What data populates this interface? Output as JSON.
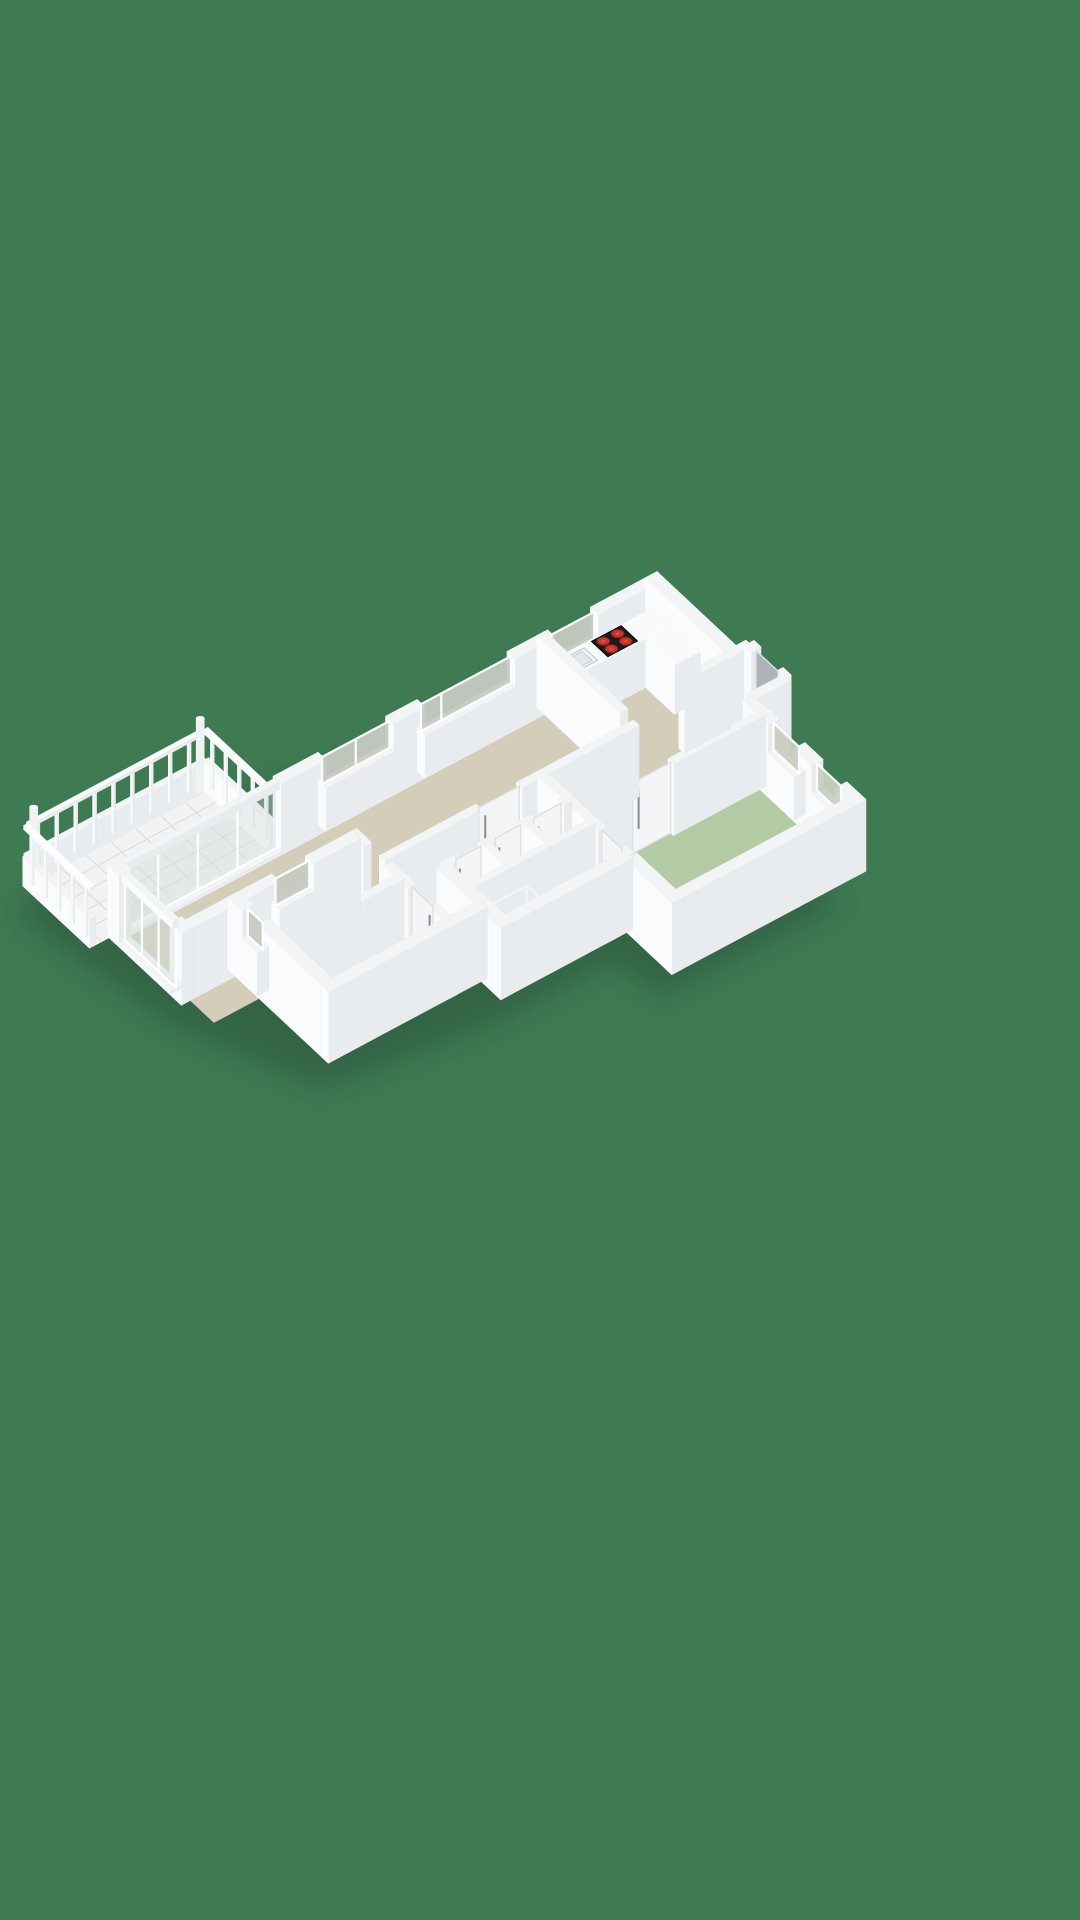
{
  "canvas": {
    "width": 1080,
    "height": 1920,
    "background": "#3E7A52"
  },
  "palette": {
    "bg": "#3E7A52",
    "shadow": "#26523A",
    "wallTop": "#F2F4F5",
    "faceSW": "#FAFBFC",
    "faceSE": "#E9ECEE",
    "faceNE": "#C6CACE",
    "faceNW": "#DADDE0",
    "floorBeige": "#D4CDBA",
    "floorGreen": "#B3CBA4",
    "floorBlue": "#8FA7C3",
    "floorLight": "#E8E6DF",
    "tile": "#F0F2F3",
    "grout": "#D9DCDE",
    "glassWin": "#C5C9C1",
    "glassGreen": "#C9CFC0",
    "glassSlide": "#D4DCDB",
    "glassShower": "#E6EDF1",
    "counterTop": "#F8FAFB",
    "doorWhite": "#F4F5F6",
    "doorGray": "#ADB3B8",
    "handle": "#878D92",
    "cooktop": "#1A1B1D",
    "burner": "#C8342B",
    "equipRed": "#B23028",
    "equipDark": "#2A2D30",
    "post": "#EFF2F3",
    "trayWhite": "#EDF0F2",
    "sinkFill": "#F2F5F6",
    "sinkEdge": "#C9CED2"
  },
  "projection": {
    "ox": 655,
    "oy": 650,
    "xx": 30,
    "xy": 28,
    "yx": -45,
    "yy": 24,
    "zz": 56,
    "wall_height": 1.28
  },
  "scene": [
    {
      "t": "shadow",
      "name": "ground-shadow",
      "pts": [
        [
          0.4,
          0.5
        ],
        [
          7.8,
          1.0
        ],
        [
          7.7,
          4.9
        ],
        [
          6.3,
          5.1
        ],
        [
          6.3,
          7.6
        ],
        [
          5.7,
          11.1
        ],
        [
          2.4,
          12.3
        ],
        [
          -2.1,
          12.8
        ],
        [
          -2.4,
          8.7
        ],
        [
          0.2,
          2.5
        ]
      ],
      "blur": 14,
      "op": 0.55
    },
    {
      "t": "floor",
      "name": "floor-kitchen",
      "r": [
        0.1,
        0.1,
        2.62,
        2.45
      ],
      "c": "floorBeige"
    },
    {
      "t": "floor",
      "name": "floor-hall",
      "r": [
        2.45,
        -0.22,
        4.42,
        4.62
      ],
      "c": "floorBeige"
    },
    {
      "t": "floor",
      "name": "floor-living-room",
      "r": [
        0.1,
        2.45,
        3.12,
        11.88
      ],
      "c": "floorBeige"
    },
    {
      "t": "floor",
      "name": "floor-corridor",
      "r": [
        3.05,
        4.55,
        3.95,
        8.15
      ],
      "c": "floorBeige"
    },
    {
      "t": "floor",
      "name": "floor-green-bedroom",
      "r": [
        4.35,
        0.6,
        7.4,
        4.5
      ],
      "c": "floorGreen"
    },
    {
      "t": "floor",
      "name": "floor-tech-closet",
      "r": [
        3.95,
        4.6,
        4.75,
        5.5
      ],
      "c": "floorLight"
    },
    {
      "t": "floor",
      "name": "floor-closets",
      "r": [
        3.95,
        5.5,
        4.75,
        7.3
      ],
      "c": "floorLight"
    },
    {
      "t": "floor",
      "name": "floor-bathroom",
      "r": [
        4.75,
        4.6,
        5.9,
        7.3
      ],
      "c": "floorBlue"
    },
    {
      "t": "floor",
      "name": "floor-bedroom-a",
      "r": [
        2.2,
        8.1,
        3.69,
        10.72
      ],
      "c": "floorBeige"
    },
    {
      "t": "floor",
      "name": "floor-bedroom-b",
      "r": [
        3.69,
        8.1,
        5.26,
        10.72
      ],
      "c": "floorBeige"
    },
    {
      "t": "floor",
      "name": "floor-balcony-tiles",
      "r": [
        -2.3,
        8.45,
        -0.08,
        12.45
      ],
      "c": "tile"
    },
    {
      "t": "grid",
      "name": "balcony-tile-grout",
      "xs": [
        -1.86,
        -1.42,
        -0.98,
        -0.54
      ],
      "ys": [
        8.95,
        9.5,
        10.05,
        10.6,
        11.15,
        11.7,
        12.25
      ],
      "ya": 8.45,
      "yb": 12.45,
      "xa": -2.3,
      "xb": -0.08,
      "c": "grout"
    },
    {
      "t": "wy",
      "name": "balcony-parapet-nw",
      "x": -2.3,
      "a": 8.45,
      "b": 12.45,
      "th": 0.13,
      "h": 0.52
    },
    {
      "t": "picketsY",
      "name": "balcony-railing-nw",
      "x": -2.3,
      "a": 8.82,
      "b": 12.18,
      "step": 0.42,
      "th": 0.05,
      "h": 0.99
    },
    {
      "t": "rail",
      "name": "balcony-toprail-nw",
      "r": [
        -2.345,
        8.5,
        -2.255,
        12.4
      ],
      "z0": 1.0,
      "z1": 1.07
    },
    {
      "t": "wx",
      "name": "balcony-parapet-n",
      "y": 8.45,
      "a": -2.3,
      "b": -0.08,
      "th": 0.13,
      "h": 0.52
    },
    {
      "t": "picketsX",
      "name": "balcony-railing-n",
      "y": 8.45,
      "a": -2.08,
      "b": -0.28,
      "step": 0.45,
      "th": 0.05,
      "h": 0.99
    },
    {
      "t": "rail",
      "name": "balcony-toprail-n",
      "r": [
        -2.3,
        8.405,
        -0.1,
        8.495
      ],
      "z0": 1.0,
      "z1": 1.07
    },
    {
      "t": "cyl",
      "name": "balcony-post-west",
      "x": -2.26,
      "y": 8.6,
      "r": 0.09,
      "h": 1.34
    },
    {
      "t": "cyl",
      "name": "balcony-post-south",
      "x": -2.26,
      "y": 12.3,
      "r": 0.09,
      "h": 1.34
    },
    {
      "t": "wy",
      "name": "facade-nw",
      "x": 0,
      "a": -0.13,
      "b": 12.08,
      "th": 0.26,
      "h": 1.28,
      "op": [
        {
          "k": "win",
          "a": 1.35,
          "b": 2.3,
          "g": "glassWin"
        },
        {
          "k": "win",
          "a": 3.2,
          "b": 5.2,
          "m": [
            4.75
          ],
          "g": "glassWin"
        },
        {
          "k": "win",
          "a": 5.9,
          "b": 7.4,
          "m": [
            6.65
          ],
          "g": "glassWin"
        },
        {
          "k": "glz",
          "a": 8.4,
          "b": 11.9,
          "m": [
            9.28,
            10.16,
            11.04
          ],
          "g": "glassSlide"
        }
      ]
    },
    {
      "t": "wx",
      "name": "wall-kitchen-north",
      "y": 0,
      "a": -0.13,
      "b": 2.61,
      "th": 0.26,
      "h": 1.28
    },
    {
      "t": "wy",
      "name": "wall-entry-niche-west",
      "x": 2.61,
      "a": -0.35,
      "b": 0.13,
      "th": 0.2,
      "h": 1.28
    },
    {
      "t": "wx",
      "name": "wall-entry-niche-north",
      "y": -0.35,
      "a": 2.61,
      "b": 3.85,
      "th": 0.22,
      "h": 1.28,
      "op": [
        {
          "k": "door",
          "a": 2.84,
          "b": 3.58,
          "c": "doorGray"
        }
      ]
    },
    {
      "t": "wy",
      "name": "wall-entry-niche-east",
      "x": 3.85,
      "a": -0.35,
      "b": 0.5,
      "th": 0.22,
      "h": 1.28
    },
    {
      "t": "wx",
      "name": "wall-entry-link",
      "y": 0.5,
      "a": 3.85,
      "b": 4.35,
      "th": 0.22,
      "h": 1.28
    },
    {
      "t": "wx",
      "name": "wall-green-bedroom-north",
      "y": 0.5,
      "a": 4.35,
      "b": 7.58,
      "th": 0.26,
      "h": 1.28,
      "op": [
        {
          "k": "win",
          "a": 4.7,
          "b": 5.55,
          "g": "glassGreen"
        },
        {
          "k": "win",
          "a": 6.15,
          "b": 6.95,
          "g": "glassGreen"
        }
      ]
    },
    {
      "t": "wy",
      "name": "wall-green-bedroom-east",
      "x": 7.45,
      "a": 0.37,
      "b": 4.68,
      "th": 0.26,
      "h": 1.28
    },
    {
      "t": "wx",
      "name": "wall-green-bedroom-south",
      "y": 4.55,
      "a": 5.95,
      "b": 7.58,
      "th": 0.26,
      "h": 1.28
    },
    {
      "t": "wy",
      "name": "wall-green-bedroom-west",
      "x": 4.35,
      "a": 0.5,
      "b": 4.55,
      "th": 0.18,
      "h": 1.28,
      "op": [
        {
          "k": "door",
          "a": 2.55,
          "b": 3.4,
          "c": "doorWhite"
        }
      ]
    },
    {
      "t": "wy",
      "name": "wall-kitchen-stub",
      "x": 2.61,
      "a": 0.13,
      "b": 1.15,
      "th": 0.18,
      "h": 1.28
    },
    {
      "t": "box",
      "name": "kitchen-counter-main",
      "r": [
        0.13,
        0.13,
        0.74,
        2.4
      ],
      "z1": 0.88,
      "cols": {
        "top": "counterTop"
      }
    },
    {
      "t": "box",
      "name": "kitchen-counter-corner",
      "r": [
        0.74,
        0.13,
        1.7,
        0.7
      ],
      "z1": 0.88,
      "cols": {
        "top": "counterTop"
      }
    },
    {
      "t": "flat",
      "name": "kitchen-sink",
      "r": [
        0.22,
        1.72,
        0.66,
        2.22
      ],
      "z": 0.885,
      "c": "sinkFill",
      "st": "sinkEdge",
      "sw": 1.4
    },
    {
      "t": "flat",
      "name": "kitchen-sink-basin",
      "r": [
        0.28,
        1.8,
        0.6,
        2.14
      ],
      "z": 0.887,
      "c": "#E2E7EA",
      "st": "sinkEdge",
      "sw": 1
    },
    {
      "t": "cooktop",
      "name": "cooktop",
      "r": [
        0.16,
        0.86,
        0.71,
        1.52
      ],
      "z": 0.885,
      "br": 0.16,
      "burners": [
        [
          0.3,
          1.03
        ],
        [
          0.57,
          1.03
        ],
        [
          0.3,
          1.35
        ],
        [
          0.57,
          1.35
        ]
      ]
    },
    {
      "t": "wx",
      "name": "wall-kitchen-south",
      "y": 2.45,
      "a": -0.13,
      "b": 2.64,
      "th": 0.18,
      "h": 1.28
    },
    {
      "t": "wy",
      "name": "wall-living-east",
      "x": 3.05,
      "a": 2.45,
      "b": 8.1,
      "th": 0.18,
      "h": 1.28,
      "op": [
        {
          "k": "door",
          "a": 5.05,
          "b": 5.95,
          "c": "doorWhite"
        }
      ]
    },
    {
      "t": "wx",
      "name": "wall-cluster-north",
      "y": 4.55,
      "a": 3.05,
      "b": 5.95,
      "th": 0.18,
      "h": 1.28,
      "op": [
        {
          "k": "door",
          "a": 5.05,
          "b": 5.72,
          "c": "doorWhite"
        }
      ]
    },
    {
      "t": "wy",
      "name": "wall-cluster-west",
      "x": 3.95,
      "a": 4.55,
      "b": 7.35,
      "th": 0.18,
      "h": 1.28,
      "op": [
        {
          "k": "door",
          "a": 4.72,
          "b": 5.32,
          "c": "doorWhite"
        },
        {
          "k": "door",
          "a": 5.62,
          "b": 6.18,
          "c": "doorWhite"
        },
        {
          "k": "door",
          "a": 6.5,
          "b": 7.06,
          "c": "doorWhite"
        }
      ]
    },
    {
      "t": "box",
      "name": "boiler-red",
      "r": [
        4.12,
        4.78,
        4.48,
        5.35
      ],
      "z1": 0.5,
      "cols": {
        "top": "equipRed",
        "px": "equipRed",
        "py": "#9C2822",
        "nx": "#8F231E",
        "ny": "#9C2822"
      }
    },
    {
      "t": "box",
      "name": "boiler-dark",
      "r": [
        4.17,
        4.84,
        4.44,
        5.22
      ],
      "z0": 0.5,
      "z1": 0.82,
      "cols": {
        "top": "equipDark",
        "px": "#33373B",
        "py": "#2A2D30",
        "nx": "#232629",
        "ny": "#2A2D30"
      }
    },
    {
      "t": "wx",
      "name": "wall-closet-partition-1",
      "y": 5.5,
      "a": 3.95,
      "b": 4.75,
      "th": 0.14,
      "h": 1.28
    },
    {
      "t": "wx",
      "name": "wall-closet-partition-2",
      "y": 6.4,
      "a": 3.95,
      "b": 4.75,
      "th": 0.14,
      "h": 1.28
    },
    {
      "t": "wy",
      "name": "wall-bath-west",
      "x": 4.75,
      "a": 4.55,
      "b": 7.35,
      "th": 0.14,
      "h": 1.28
    },
    {
      "t": "box",
      "name": "bath-vanity",
      "r": [
        5.6,
        4.7,
        5.87,
        5.38
      ],
      "z1": 0.46,
      "cols": {
        "top": "#FBFCFD"
      }
    },
    {
      "t": "box",
      "name": "bath-toilet",
      "r": [
        5.02,
        4.68,
        5.34,
        5.02
      ],
      "z1": 0.4,
      "cols": {
        "top": "#FBFCFD"
      }
    },
    {
      "t": "flat",
      "name": "shower-tray",
      "r": [
        5.32,
        6.4,
        5.88,
        7.26
      ],
      "z": 0.01,
      "c": "trayWhite",
      "st": "#DFE3E6",
      "sw": 1
    },
    {
      "t": "glassY",
      "name": "shower-glass-long",
      "x": 5.3,
      "a": 6.38,
      "b": 7.28,
      "z0": 0.02,
      "z1": 1.18
    },
    {
      "t": "glassX",
      "name": "shower-glass-short",
      "y": 6.38,
      "a": 5.3,
      "b": 5.88,
      "z0": 0.02,
      "z1": 1.18
    },
    {
      "t": "wx",
      "name": "wall-cluster-south",
      "y": 7.35,
      "a": 3.95,
      "b": 6.08,
      "th": 0.26,
      "h": 1.28
    },
    {
      "t": "wy",
      "name": "wall-cluster-east",
      "x": 5.95,
      "a": 4.55,
      "b": 7.48,
      "th": 0.26,
      "h": 1.28
    },
    {
      "t": "wx",
      "name": "wall-bedrooms-north",
      "y": 8.1,
      "a": 2.07,
      "b": 5.43,
      "th": 0.18,
      "h": 1.28,
      "op": [
        {
          "k": "gap",
          "a": 2.55,
          "b": 3.25
        },
        {
          "k": "door",
          "a": 4.05,
          "b": 4.75,
          "c": "doorWhite"
        }
      ]
    },
    {
      "t": "wy",
      "name": "wall-bedroom-partition",
      "x": 3.69,
      "a": 8.1,
      "b": 10.75,
      "th": 0.18,
      "h": 1.28
    },
    {
      "t": "wy",
      "name": "wall-wing-west",
      "x": 2.2,
      "a": 8.1,
      "b": 12.08,
      "th": 0.26,
      "h": 1.28,
      "op": [
        {
          "k": "win",
          "a": 9.15,
          "b": 9.9,
          "g": "glassWin"
        }
      ]
    },
    {
      "t": "wx",
      "name": "wall-wing-south",
      "y": 10.75,
      "a": 2.07,
      "b": 5.43,
      "th": 0.26,
      "h": 1.28,
      "op": [
        {
          "k": "win",
          "a": 2.55,
          "b": 3.05,
          "g": "glassWin"
        }
      ]
    },
    {
      "t": "wy",
      "name": "wall-wing-east",
      "x": 5.3,
      "a": 7.35,
      "b": 10.88,
      "th": 0.26,
      "h": 1.28
    },
    {
      "t": "wx",
      "name": "facade-sw",
      "y": 11.95,
      "a": -0.13,
      "b": 2.33,
      "th": 0.26,
      "h": 1.28,
      "op": [
        {
          "k": "glz",
          "a": 0.25,
          "b": 1.95,
          "m": [
            0.82,
            1.38
          ],
          "g": "glassSlide"
        }
      ]
    },
    {
      "t": "wx",
      "name": "balcony-parapet-sw",
      "y": 12.45,
      "a": -2.3,
      "b": -0.08,
      "th": 0.13,
      "h": 0.52
    },
    {
      "t": "picketsX",
      "name": "balcony-railing-sw",
      "y": 12.45,
      "a": -2.08,
      "b": -0.28,
      "step": 0.45,
      "th": 0.05,
      "h": 0.99
    },
    {
      "t": "rail",
      "name": "balcony-toprail-sw",
      "r": [
        -2.3,
        12.405,
        -0.1,
        12.495
      ],
      "z0": 1.0,
      "z1": 1.07
    }
  ]
}
